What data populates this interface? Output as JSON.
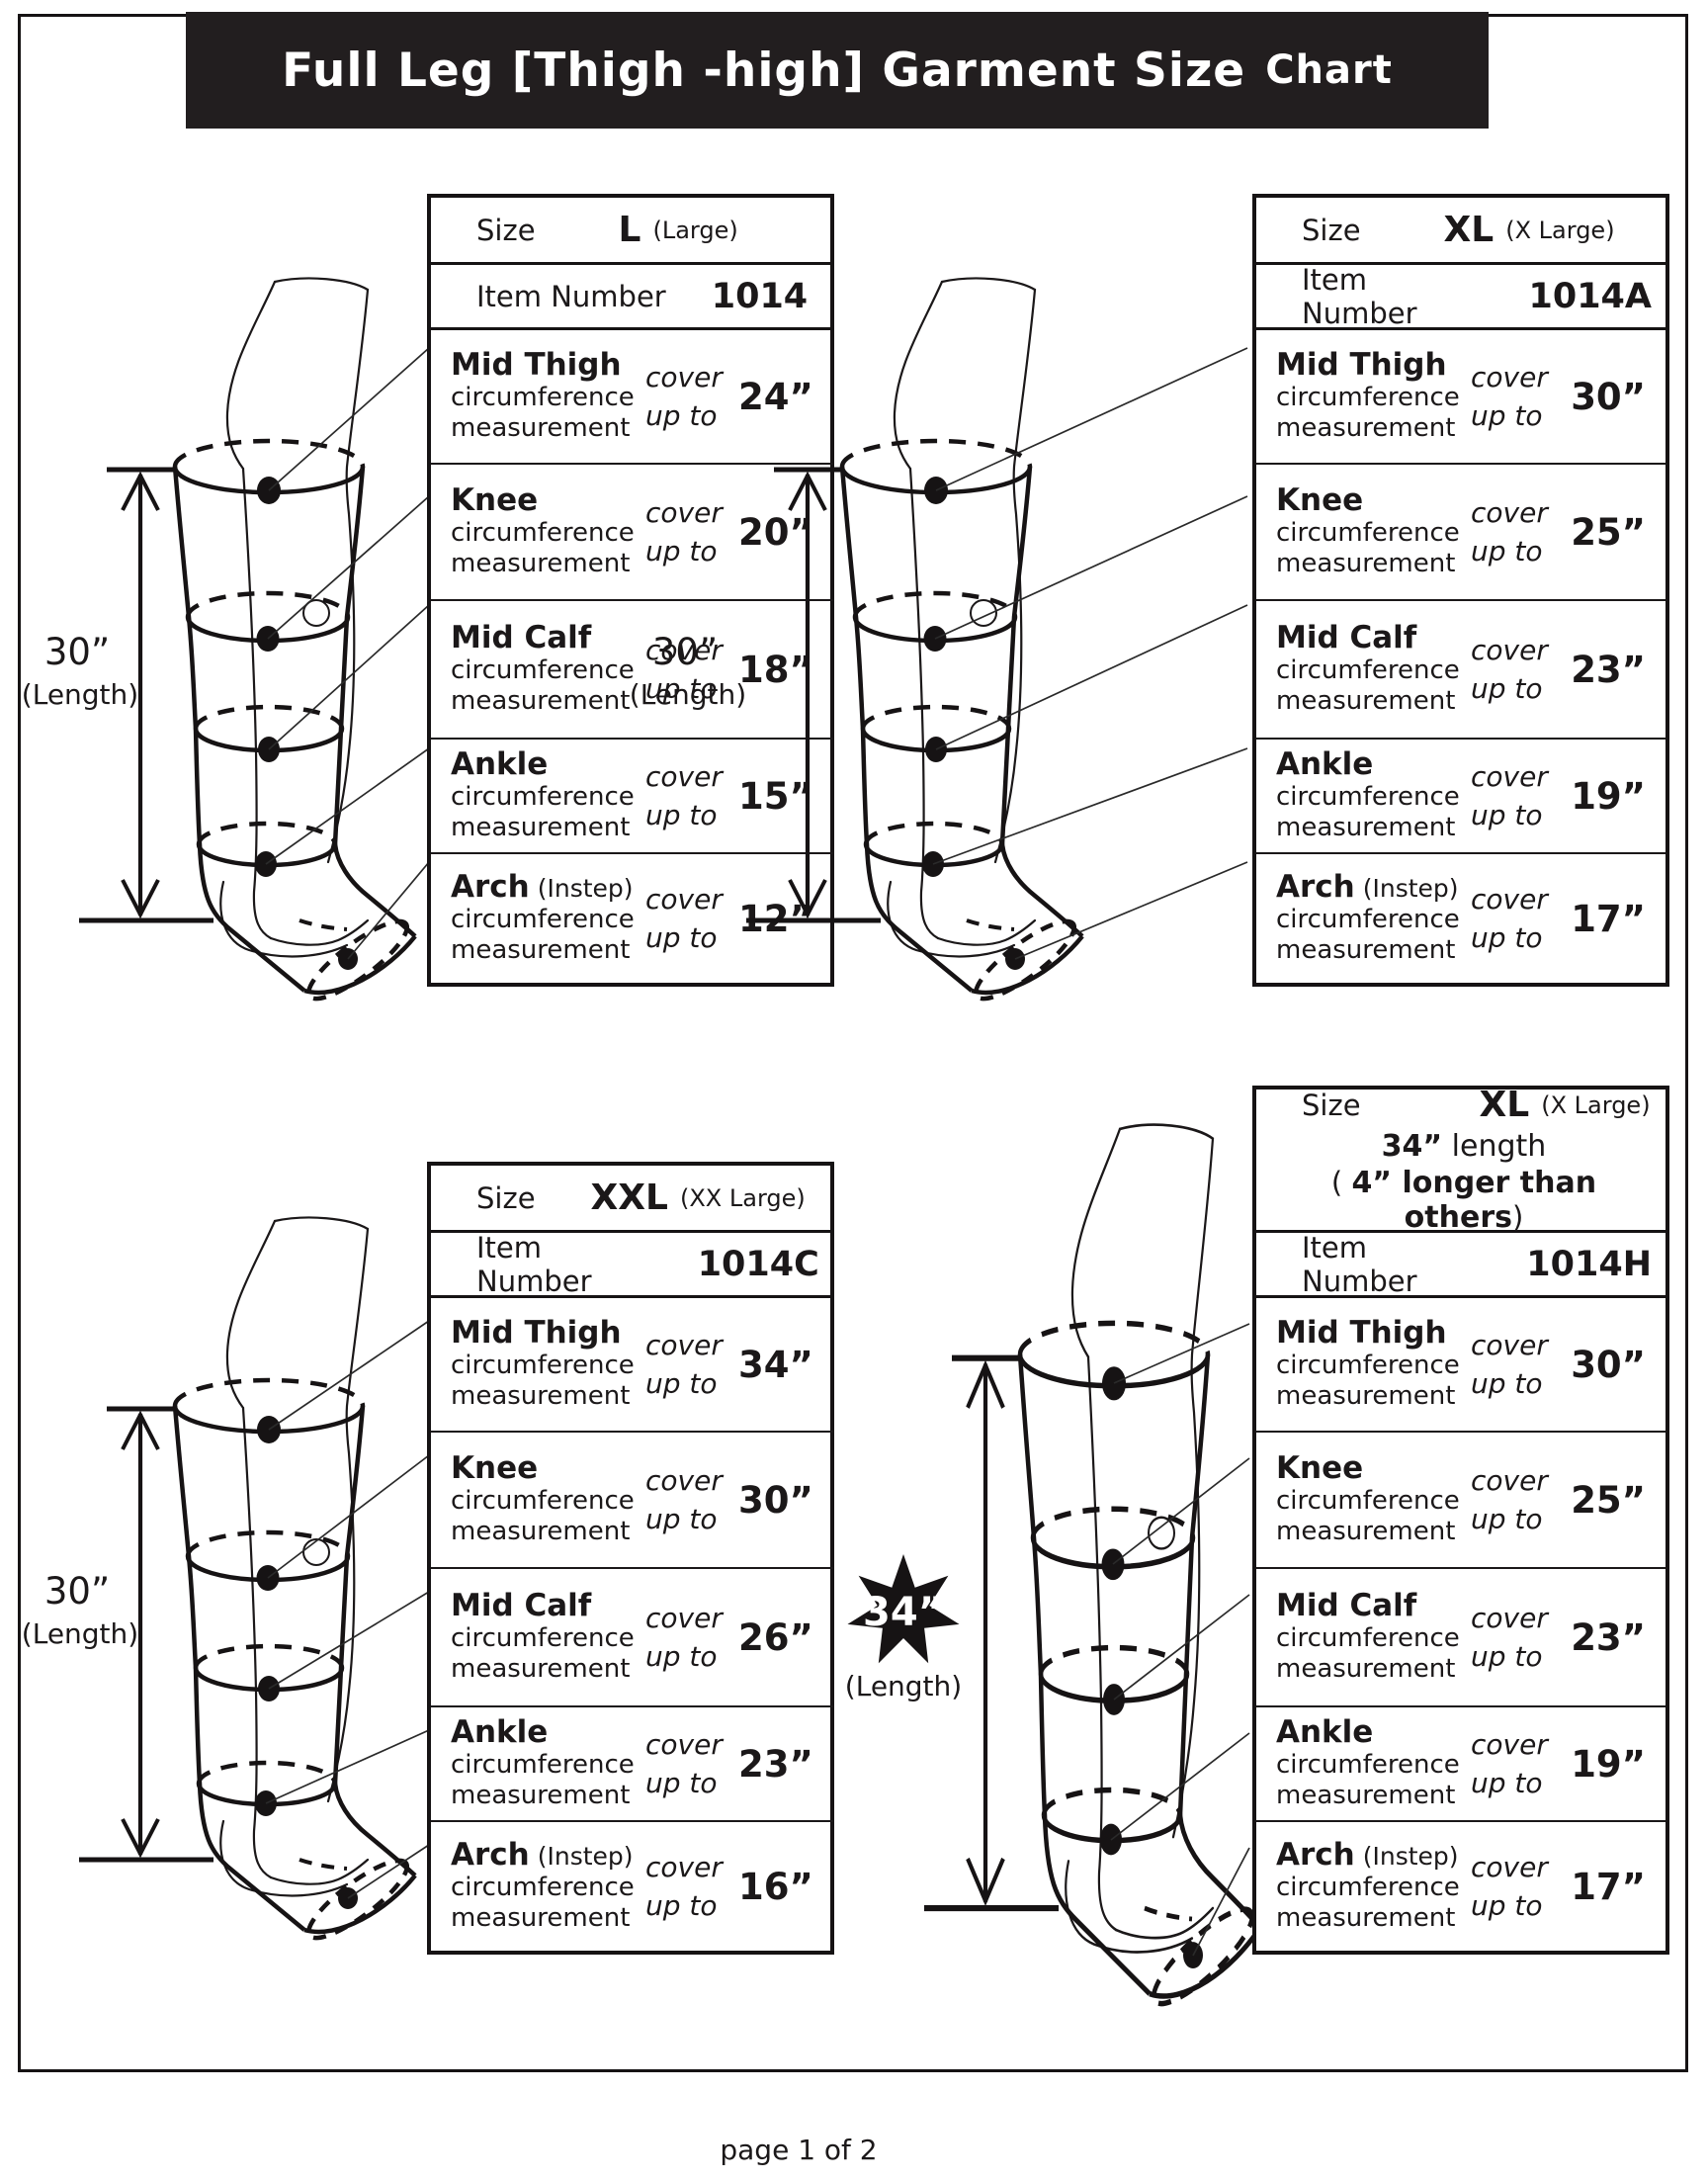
{
  "page": {
    "title_main": "Full Leg  [Thigh -high]  Garment  Size",
    "title_last": "Chart",
    "footer": "page 1 of 2"
  },
  "labels": {
    "size": "Size",
    "item_number": "Item Number",
    "circumference": "circumference",
    "measurement": "measurement",
    "cover": "cover",
    "up_to": "up to"
  },
  "panels": [
    {
      "size_code": "L",
      "size_name": "(Large)",
      "item": "1014",
      "length": "30”",
      "length_sub": "(Length)",
      "rows": [
        {
          "name": "Mid Thigh",
          "suffix": "",
          "value": "24”"
        },
        {
          "name": "Knee",
          "suffix": "",
          "value": "20”"
        },
        {
          "name": "Mid Calf",
          "suffix": "",
          "value": "18”"
        },
        {
          "name": "Ankle",
          "suffix": "",
          "value": "15”"
        },
        {
          "name": "Arch",
          "suffix": "(Instep)",
          "value": "12”"
        }
      ]
    },
    {
      "size_code": "XL",
      "size_name": "(X Large)",
      "item": "1014A",
      "length": "30”",
      "length_sub": "(Length)",
      "rows": [
        {
          "name": "Mid Thigh",
          "suffix": "",
          "value": "30”"
        },
        {
          "name": "Knee",
          "suffix": "",
          "value": "25”"
        },
        {
          "name": "Mid Calf",
          "suffix": "",
          "value": "23”"
        },
        {
          "name": "Ankle",
          "suffix": "",
          "value": "19”"
        },
        {
          "name": "Arch",
          "suffix": "(Instep)",
          "value": "17”"
        }
      ]
    },
    {
      "size_code": "XXL",
      "size_name": "(XX Large)",
      "item": "1014C",
      "length": "30”",
      "length_sub": "(Length)",
      "rows": [
        {
          "name": "Mid Thigh",
          "suffix": "",
          "value": "34”"
        },
        {
          "name": "Knee",
          "suffix": "",
          "value": "30”"
        },
        {
          "name": "Mid Calf",
          "suffix": "",
          "value": "26”"
        },
        {
          "name": "Ankle",
          "suffix": "",
          "value": "23”"
        },
        {
          "name": "Arch",
          "suffix": "(Instep)",
          "value": "16”"
        }
      ]
    },
    {
      "size_code": "XL",
      "size_name": "(X Large)",
      "item": "1014H",
      "size_line2_b": "34”",
      "size_line2_r": " length",
      "size_line3_open": "( ",
      "size_line3_b": "4” longer than others",
      "size_line3_close": ")",
      "length": "34”",
      "length_sub": "(Length)",
      "rows": [
        {
          "name": "Mid Thigh",
          "suffix": "",
          "value": "30”"
        },
        {
          "name": "Knee",
          "suffix": "",
          "value": "25”"
        },
        {
          "name": "Mid Calf",
          "suffix": "",
          "value": "23”"
        },
        {
          "name": "Ankle",
          "suffix": "",
          "value": "19”"
        },
        {
          "name": "Arch",
          "suffix": "(Instep)",
          "value": "17”"
        }
      ]
    }
  ]
}
